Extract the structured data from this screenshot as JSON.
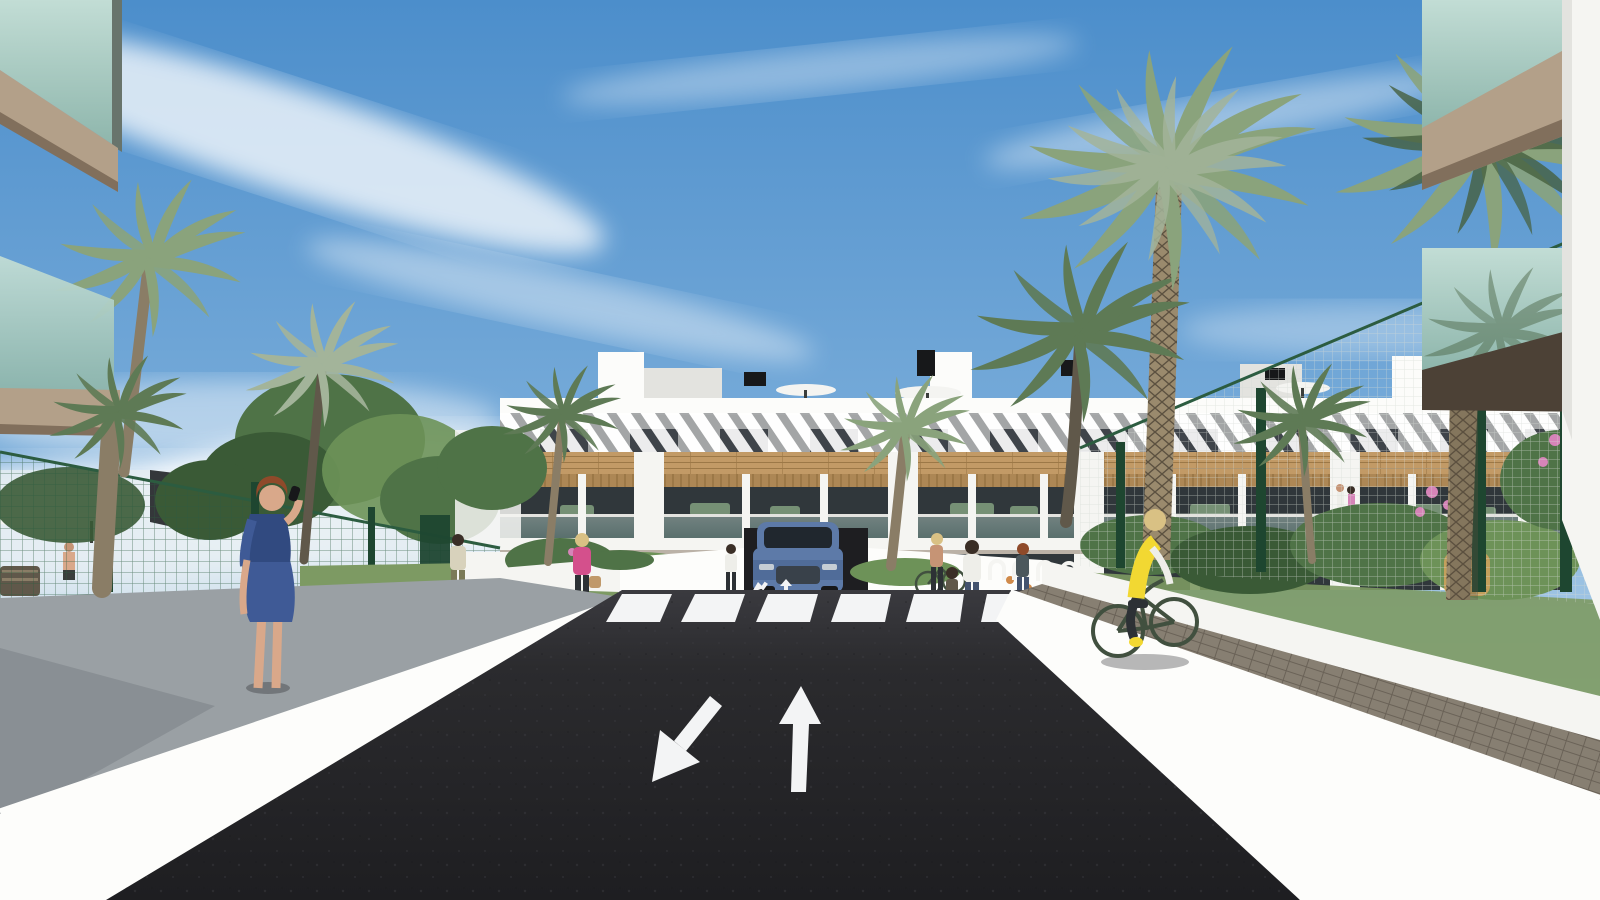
{
  "image": {
    "kind": "architectural-render",
    "description": "3D visualization of a modern white three-storey apartment complex with wood accents, palm trees, a dark asphalt access road with directional arrows and a zebra crosswalk, an SUV at an underground garage ramp, pedestrians and a cyclist",
    "width": 1600,
    "height": 900
  },
  "palette": {
    "skyTop": "#4c8ecb",
    "skyMid": "#74a9d8",
    "skyLow": "#b8d4ea",
    "skyHaze": "#e3ecf1",
    "cloud": "#ffffff",
    "white": "#f5f5f2",
    "whiteShade": "#e3e3df",
    "parapet": "#fcfcfa",
    "wallSun": "#fdfdfb",
    "wallGrayTop": "#9aa0a4",
    "wallGrayDark": "#7b8186",
    "curb": "#ececec",
    "frameDark": "#3a3d3b",
    "black": "#17181a",
    "slatDark": "#3f444a",
    "woodBand": "#c29a66",
    "woodDark": "#9c7847",
    "pergola": "#ad8755",
    "terraceGlass": "#30373b",
    "terraceGlass2": "#4b575c",
    "furnGreen": "#7e9a7c",
    "glassHi": "#c2ddd5",
    "glassLo": "#8db5ab",
    "glassEdge": "#68746c",
    "balcSlab": "#b3a089",
    "balcSlabDark": "#816f5c",
    "soffitDark": "#4c4136",
    "road": "#2b2b2e",
    "roadLight": "#3a3a3f",
    "roadDark": "#1e1e21",
    "marking": "#f3f4f5",
    "paver": "#877f72",
    "paverDark": "#6a6257",
    "pathGray": "#8f918f",
    "pathLight": "#aaaba8",
    "grass": "#7d9a63",
    "grassDark": "#5f7d4a",
    "bushGreen": "#4f7347",
    "bushDark": "#3a5a36",
    "bushLight": "#6d9258",
    "frond": "#8aa37c",
    "frondDark": "#5e7a55",
    "frondGray": "#a3b49a",
    "frondDeep": "#46603f",
    "trunk": "#8a7d66",
    "trunkDark": "#60584a",
    "trunkTex": "#9a8a6d",
    "trunkTexDark": "#5c5140",
    "fenceGreen": "#2c5c40",
    "fencePost": "#1e4630",
    "meshLight": "#d5dad5",
    "sailDark": "#34373a",
    "umbrella": "#f4f4f1",
    "skin": "#d9a88a",
    "skinTan": "#c69475",
    "blueDress": "#3f5a96",
    "blueDressDark": "#314a80",
    "pinkTop": "#d4508c",
    "yellowVest": "#f2d832",
    "jeans": "#44536e",
    "pantsDark": "#2d3135",
    "shirtBeige": "#d8d2bc",
    "olivePants": "#7b7a58",
    "whiteTop": "#eeeee9",
    "hairRed": "#8f4a2a",
    "hairBlonde": "#d9c184",
    "hairDark": "#3a2e26",
    "carBody": "#5d7aa8",
    "carBodyDark": "#46608c",
    "carGlass": "#20272e",
    "carGrille": "#39414a",
    "carSilver": "#c5cdd4",
    "bagTan": "#c0996a",
    "bikeGreen": "#41503f",
    "flowerPink": "#d684b8",
    "flowerOrange": "#d08a4a",
    "wicker": "#c4a05c"
  },
  "scene": {
    "sky": {
      "condition": "sunny",
      "clouds": "wispy white cirrus streaks"
    },
    "building": {
      "storeys": 3,
      "style": "modern Mediterranean apartment block",
      "features": [
        "white parapet roof terrace with parasols and black chimney vents",
        "top floor wrapped in white diagonal brise-soleil slats over dark windows",
        "horizontal timber cladding band",
        "middle-floor terraces with timber pergolas, white piers and glass railings",
        "ground-floor terraces behind white planter walls"
      ]
    },
    "road": {
      "surface": "dark asphalt",
      "markings": {
        "left_lane_arrow": "straight arrow pointing toward viewer (exit lane)",
        "right_lane_arrow": "straight arrow pointing away from viewer (entry lane)",
        "small_ramp_arrows": [
          "down",
          "up"
        ],
        "crosswalk_stripes": 6
      }
    },
    "vehicles": [
      {
        "type": "suv",
        "color": "steel blue",
        "position": "emerging from underground garage ramp below the building"
      }
    ],
    "people": [
      {
        "id": "woman-blue-dress",
        "description": "red-haired woman in patterned blue dress talking on phone, walking on left wall"
      },
      {
        "id": "man-beige-shirt",
        "description": "man in beige shirt and olive trousers walking away on garden path"
      },
      {
        "id": "woman-pink-top",
        "description": "blonde woman in pink top with tan handbag walking through garden"
      },
      {
        "id": "woman-white-top",
        "description": "woman in white top standing by ramp planter"
      },
      {
        "id": "cyclist-yellow-vest",
        "description": "blonde woman in yellow vest riding dark green bicycle on paver path at right"
      },
      {
        "id": "woman-with-bicycle",
        "description": "woman standing with bicycle near bike racks"
      },
      {
        "id": "mother-and-child",
        "description": "woman with child at right end of crosswalk"
      },
      {
        "id": "woman-far-right",
        "description": "woman in dark top and jeans near garden fence"
      },
      {
        "id": "man-at-pool",
        "description": "shirtless man in pool area behind left fence"
      },
      {
        "id": "balcony-residents",
        "description": "two tiny figures on a right-hand terrace"
      }
    ],
    "vegetation": {
      "palm_trees": 9,
      "other": [
        "clipped hedges",
        "leafy trees",
        "ornamental grasses"
      ],
      "flowers": [
        "pink",
        "orange"
      ]
    },
    "site_elements": [
      "green mesh perimeter fences with dark green posts",
      "dark shade sail over pool lounge area",
      "white pool parasols and timber bench",
      "white bicycle racks",
      "wicker armchair in right garden",
      "white ramp walls with bright sunlit coping"
    ],
    "foreground": {
      "top_left": "close-up glass balconies of facing building with tan slabs",
      "top_right": "close-up glass balcony, dark soffit and white party wall"
    }
  }
}
